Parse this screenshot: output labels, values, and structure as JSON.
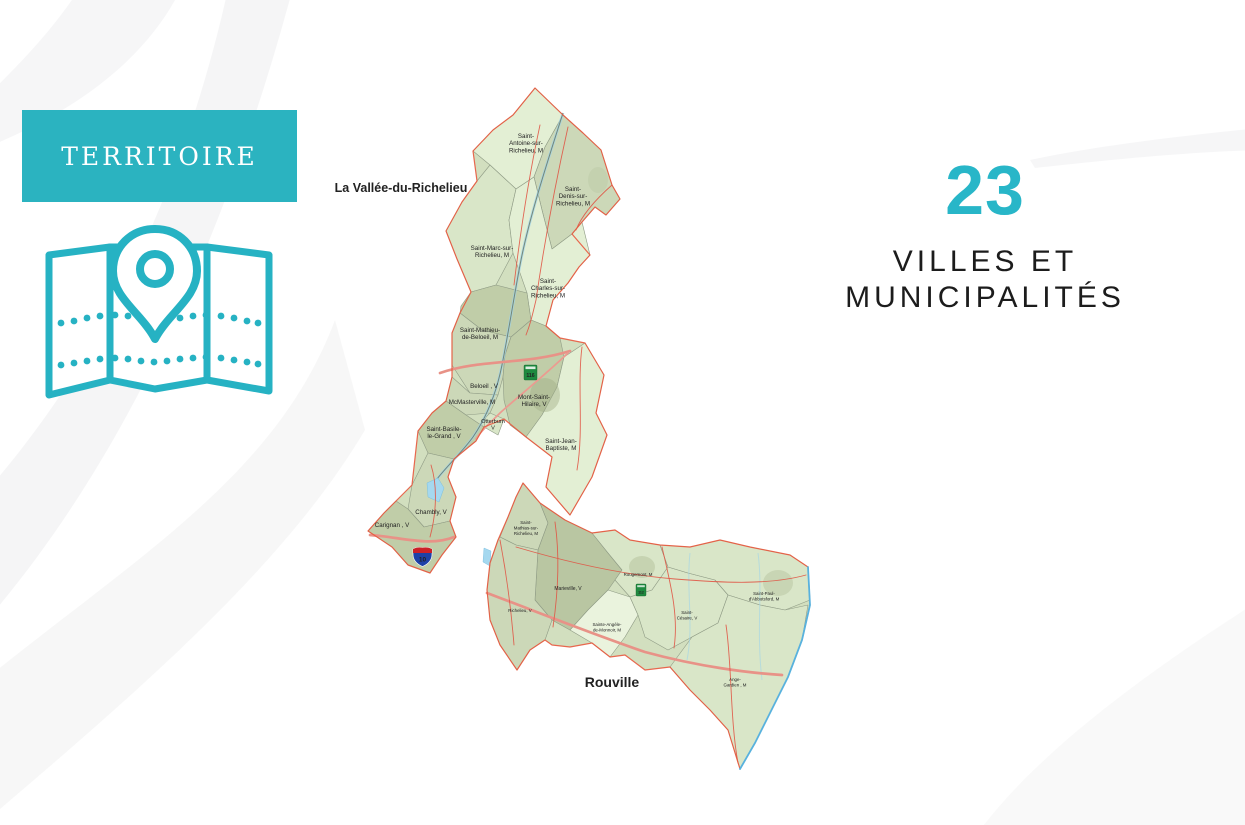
{
  "slide": {
    "banner": {
      "label": "TERRITOIRE"
    },
    "stat": {
      "value": "23",
      "label_lines": [
        "VILLES ET",
        "MUNICIPALITÉS"
      ]
    }
  },
  "map": {
    "mrc_labels": [
      {
        "text": "La Vallée-du-Richelieu",
        "x": 71,
        "y": 107,
        "fs": 12.5
      },
      {
        "text": "Rouville",
        "x": 282,
        "y": 602,
        "fs": 14
      }
    ],
    "municipalities": [
      {
        "lines": [
          "Saint-",
          "Antoine-sur-",
          "Richelieu, M"
        ],
        "x": 196,
        "y": 53,
        "fs": 6.2
      },
      {
        "lines": [
          "Saint-",
          "Denis-sur-",
          "Richelieu, M"
        ],
        "x": 243,
        "y": 106,
        "fs": 6.2
      },
      {
        "lines": [
          "Saint-Marc-sur-",
          "Richelieu, M"
        ],
        "x": 162,
        "y": 165,
        "fs": 6.2
      },
      {
        "lines": [
          "Saint-",
          "Charles-sur-",
          "Richelieu, M"
        ],
        "x": 218,
        "y": 198,
        "fs": 6.2
      },
      {
        "lines": [
          "Saint-Mathieu-",
          "de-Beloeil, M"
        ],
        "x": 150,
        "y": 247,
        "fs": 6.2
      },
      {
        "lines": [
          "Beloeil , V"
        ],
        "x": 154,
        "y": 303,
        "fs": 6.2
      },
      {
        "lines": [
          "McMasterville, M"
        ],
        "x": 142,
        "y": 319,
        "fs": 6.2
      },
      {
        "lines": [
          "Mont-Saint-",
          "Hilaire, V"
        ],
        "x": 204,
        "y": 314,
        "fs": 6.2
      },
      {
        "lines": [
          "Otterburn",
          "V"
        ],
        "x": 163,
        "y": 338,
        "fs": 5.6
      },
      {
        "lines": [
          "Saint-Basile-",
          "le-Grand , V"
        ],
        "x": 114,
        "y": 346,
        "fs": 6.2
      },
      {
        "lines": [
          "Saint-Jean-",
          "Baptiste, M"
        ],
        "x": 231,
        "y": 358,
        "fs": 6.2
      },
      {
        "lines": [
          "Chambly, V"
        ],
        "x": 101,
        "y": 429,
        "fs": 6.2
      },
      {
        "lines": [
          "Carignan , V"
        ],
        "x": 62,
        "y": 442,
        "fs": 6.2
      },
      {
        "lines": [
          "Saint-",
          "Mathias-sur-",
          "Richelieu, M"
        ],
        "x": 196,
        "y": 439,
        "fs": 4.4
      },
      {
        "lines": [
          "Marieville, V"
        ],
        "x": 238,
        "y": 505,
        "fs": 5
      },
      {
        "lines": [
          "Richelieu, V"
        ],
        "x": 190,
        "y": 527,
        "fs": 4.4
      },
      {
        "lines": [
          "Rougemont, M"
        ],
        "x": 308,
        "y": 491,
        "fs": 4.4
      },
      {
        "lines": [
          "Sainte-Angèle-",
          "de-Monnoir, M"
        ],
        "x": 277,
        "y": 541,
        "fs": 4.4
      },
      {
        "lines": [
          "Saint-",
          "Césaire, V"
        ],
        "x": 357,
        "y": 529,
        "fs": 4.4
      },
      {
        "lines": [
          "Saint-Paul-",
          "d'Abbotsford, M"
        ],
        "x": 434,
        "y": 510,
        "fs": 4.4
      },
      {
        "lines": [
          "Ange-",
          "Gardien , M"
        ],
        "x": 405,
        "y": 596,
        "fs": 4.4
      }
    ],
    "route_shields": [
      {
        "number": "116"
      },
      {
        "number": "112"
      },
      {
        "number": "10"
      }
    ]
  },
  "colors": {
    "accent_teal": "#29b5c4",
    "banner_teal": "#2bb3c0",
    "mrc_boundary_orange": "#e8593e",
    "region_edge_blue": "#58b2de",
    "text_dark": "#1c1c1c"
  }
}
